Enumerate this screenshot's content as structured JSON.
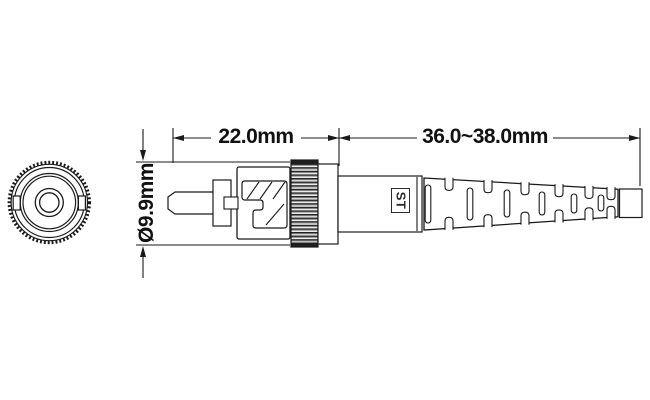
{
  "drawing": {
    "type": "technical-dimension-drawing",
    "subject": "ST fiber optic connector",
    "colors": {
      "line": "#1a1a1a",
      "background": "#ffffff"
    },
    "dimensions": {
      "body_length": "22.0mm",
      "boot_length": "36.0~38.0mm",
      "diameter": "Ø9.9mm"
    },
    "labels": {
      "connector_type": "ST"
    }
  }
}
